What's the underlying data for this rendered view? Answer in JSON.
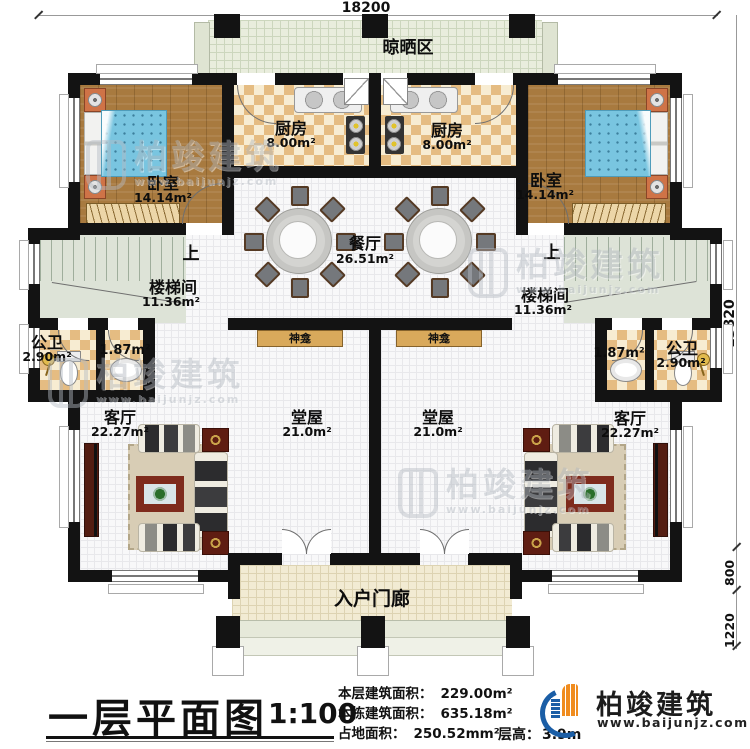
{
  "plan": {
    "drying_area": "晾晒区",
    "bedroom": {
      "name": "卧室",
      "area": "14.14m²"
    },
    "kitchen": {
      "name": "厨房",
      "area": "8.00m²"
    },
    "dining": {
      "name": "餐厅",
      "area": "26.51m²"
    },
    "stairwell": {
      "name": "楼梯间",
      "area": "11.36m²"
    },
    "up_label": "上",
    "bathroom": {
      "name": "公卫",
      "area": "2.90m²"
    },
    "washroom_area": "1.87m²",
    "living": {
      "name": "客厅",
      "area": "22.27m²"
    },
    "hall": {
      "name": "堂屋",
      "area": "21.0m²"
    },
    "shrine": "神龛",
    "porch": "入户门廊"
  },
  "dimensions": {
    "width_top": "18200",
    "height_right": "13820",
    "porch_depth": "800",
    "steps_depth": "1220"
  },
  "titleblock": {
    "title": "一层平面图",
    "scale": "1:100",
    "stats": [
      {
        "label": "本层建筑面积：",
        "value": "229.00m²"
      },
      {
        "label": "本栋建筑面积：",
        "value": "635.18m²"
      },
      {
        "label": "占地面积：",
        "value": "250.52mm²"
      }
    ],
    "floor_height_label": "层高：",
    "floor_height_value": "3.9m"
  },
  "brand": {
    "name": "柏竣建筑",
    "website": "www.baijunjz.com",
    "blue": "#1b5ea6",
    "orange": "#f08c1e"
  },
  "watermark": {
    "text": "柏竣建筑",
    "sub": "www.baijunjz.com"
  },
  "colors": {
    "wall": "#131313",
    "wood_floor": "#a87a3f",
    "kitchen_tile_dark": "#e5bc82",
    "bed_blue": "#79c5e0",
    "stair_floor": "#dde3d7",
    "porch_floor": "#f2ebd3",
    "shrine_console": "#d9a95b"
  }
}
